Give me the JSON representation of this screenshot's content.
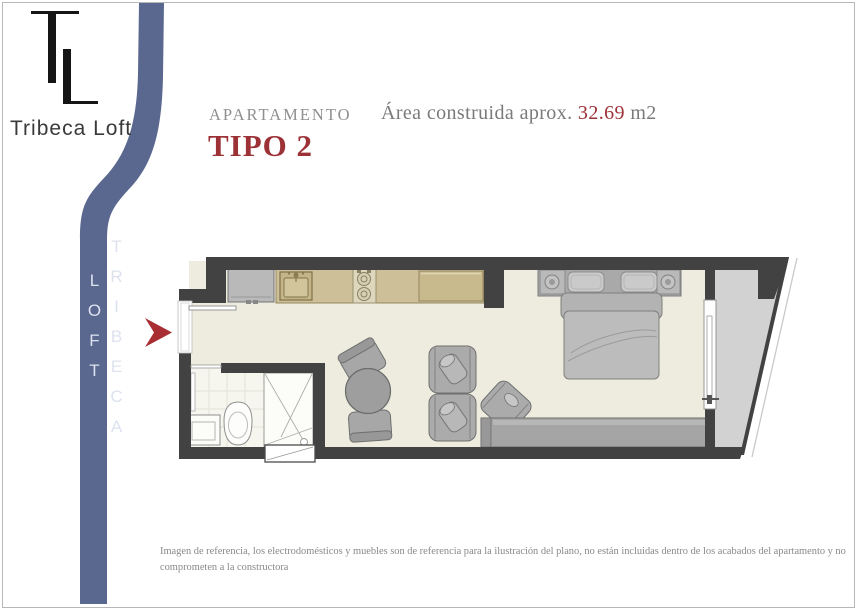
{
  "brand": {
    "logo_text": "TL",
    "name": "Tribeca Loft",
    "ribbon_word_1": "TRIBECA",
    "ribbon_word_2": "LOFT"
  },
  "header": {
    "label": "APARTAMENTO",
    "type_title": "TIPO 2",
    "area_label": "Área construida aprox.",
    "area_value": "32.69",
    "area_unit": "m2"
  },
  "footer": {
    "disclaimer": "Imagen de referencia, los electrodomésticos y muebles son de referencia para la ilustración del plano, no están incluidas dentro de los acabados del apartamento y no comprometen a la constructora"
  },
  "colors": {
    "accent_red": "#9c3136",
    "ribbon_blue": "#5a6890",
    "wall_dark": "#424242",
    "floor_cream": "#edecdf",
    "balcony_gray": "#d2d2d2",
    "counter_tan": "#cdbf97",
    "furniture_gray": "#ababab",
    "arrow_red": "#a82e34",
    "bathroom_floor": "#f6f5ee"
  }
}
